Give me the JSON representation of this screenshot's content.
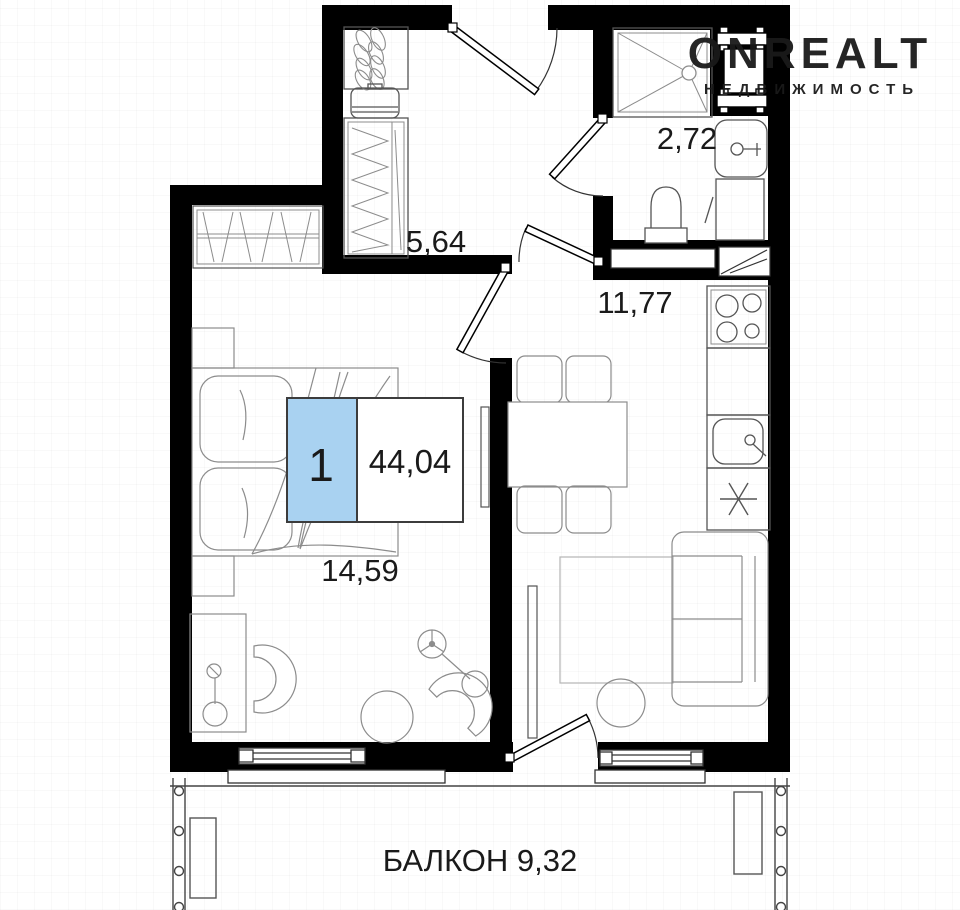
{
  "plan": {
    "title": "1-room apartment floor plan",
    "unit_badge": {
      "rooms": "1",
      "total_area": "44,04"
    },
    "labels": {
      "bathroom_area": "2,72",
      "hallway_area": "5,64",
      "kitchen_living_area": "11,77",
      "bedroom_area": "14,59",
      "balcony": "БАЛКОН 9,32"
    },
    "watermark": {
      "brand": "ONREALT",
      "tagline": "НЕДВИЖИМОСТЬ"
    },
    "colors": {
      "wall": "#000000",
      "badge_blue": "#a9d2f1",
      "badge_border": "#3c3c3c",
      "fixture_line": "#555555",
      "furniture_line": "#8c8c8c",
      "watermark": "#f0f0f0"
    }
  }
}
